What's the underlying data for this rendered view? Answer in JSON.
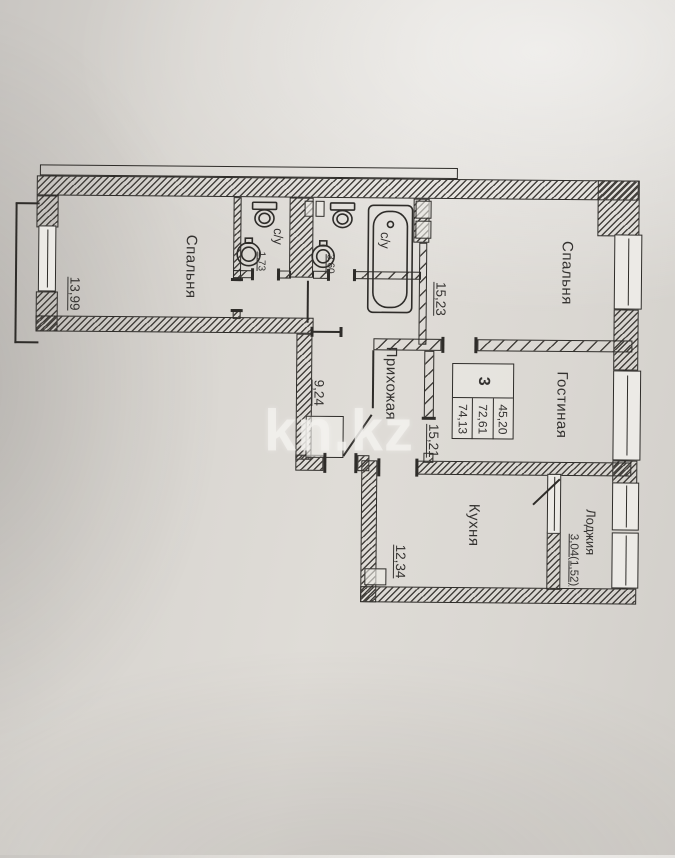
{
  "watermark": "kn.kz",
  "colors": {
    "paper": "#dcd9d4",
    "ink": "#2e2c29",
    "watermark": "#f3f1ed"
  },
  "icons": [
    "toilet-icon",
    "sink-icon",
    "bathtub-icon",
    "door-swing-icon",
    "window-icon"
  ],
  "stamp": {
    "rooms_count": "3",
    "areas": [
      "74,13",
      "72,61",
      "45,20"
    ]
  },
  "rooms": {
    "bedroom1": {
      "label": "Спальня",
      "area": "13,99"
    },
    "bathroom1": {
      "label": "с/у",
      "area": "1,73"
    },
    "bathroom2": {
      "label": "с/у",
      "area": "3,60"
    },
    "bedroom2": {
      "label": "Спальня",
      "area": "15,23"
    },
    "hallway": {
      "label": "Прихожая",
      "area": "9,24"
    },
    "living": {
      "label": "Гостиная",
      "area": "15,21"
    },
    "kitchen": {
      "label": "Кухня",
      "area": "12,34"
    },
    "loggia": {
      "label": "Лоджия",
      "area": "3,04(1,52)"
    }
  }
}
